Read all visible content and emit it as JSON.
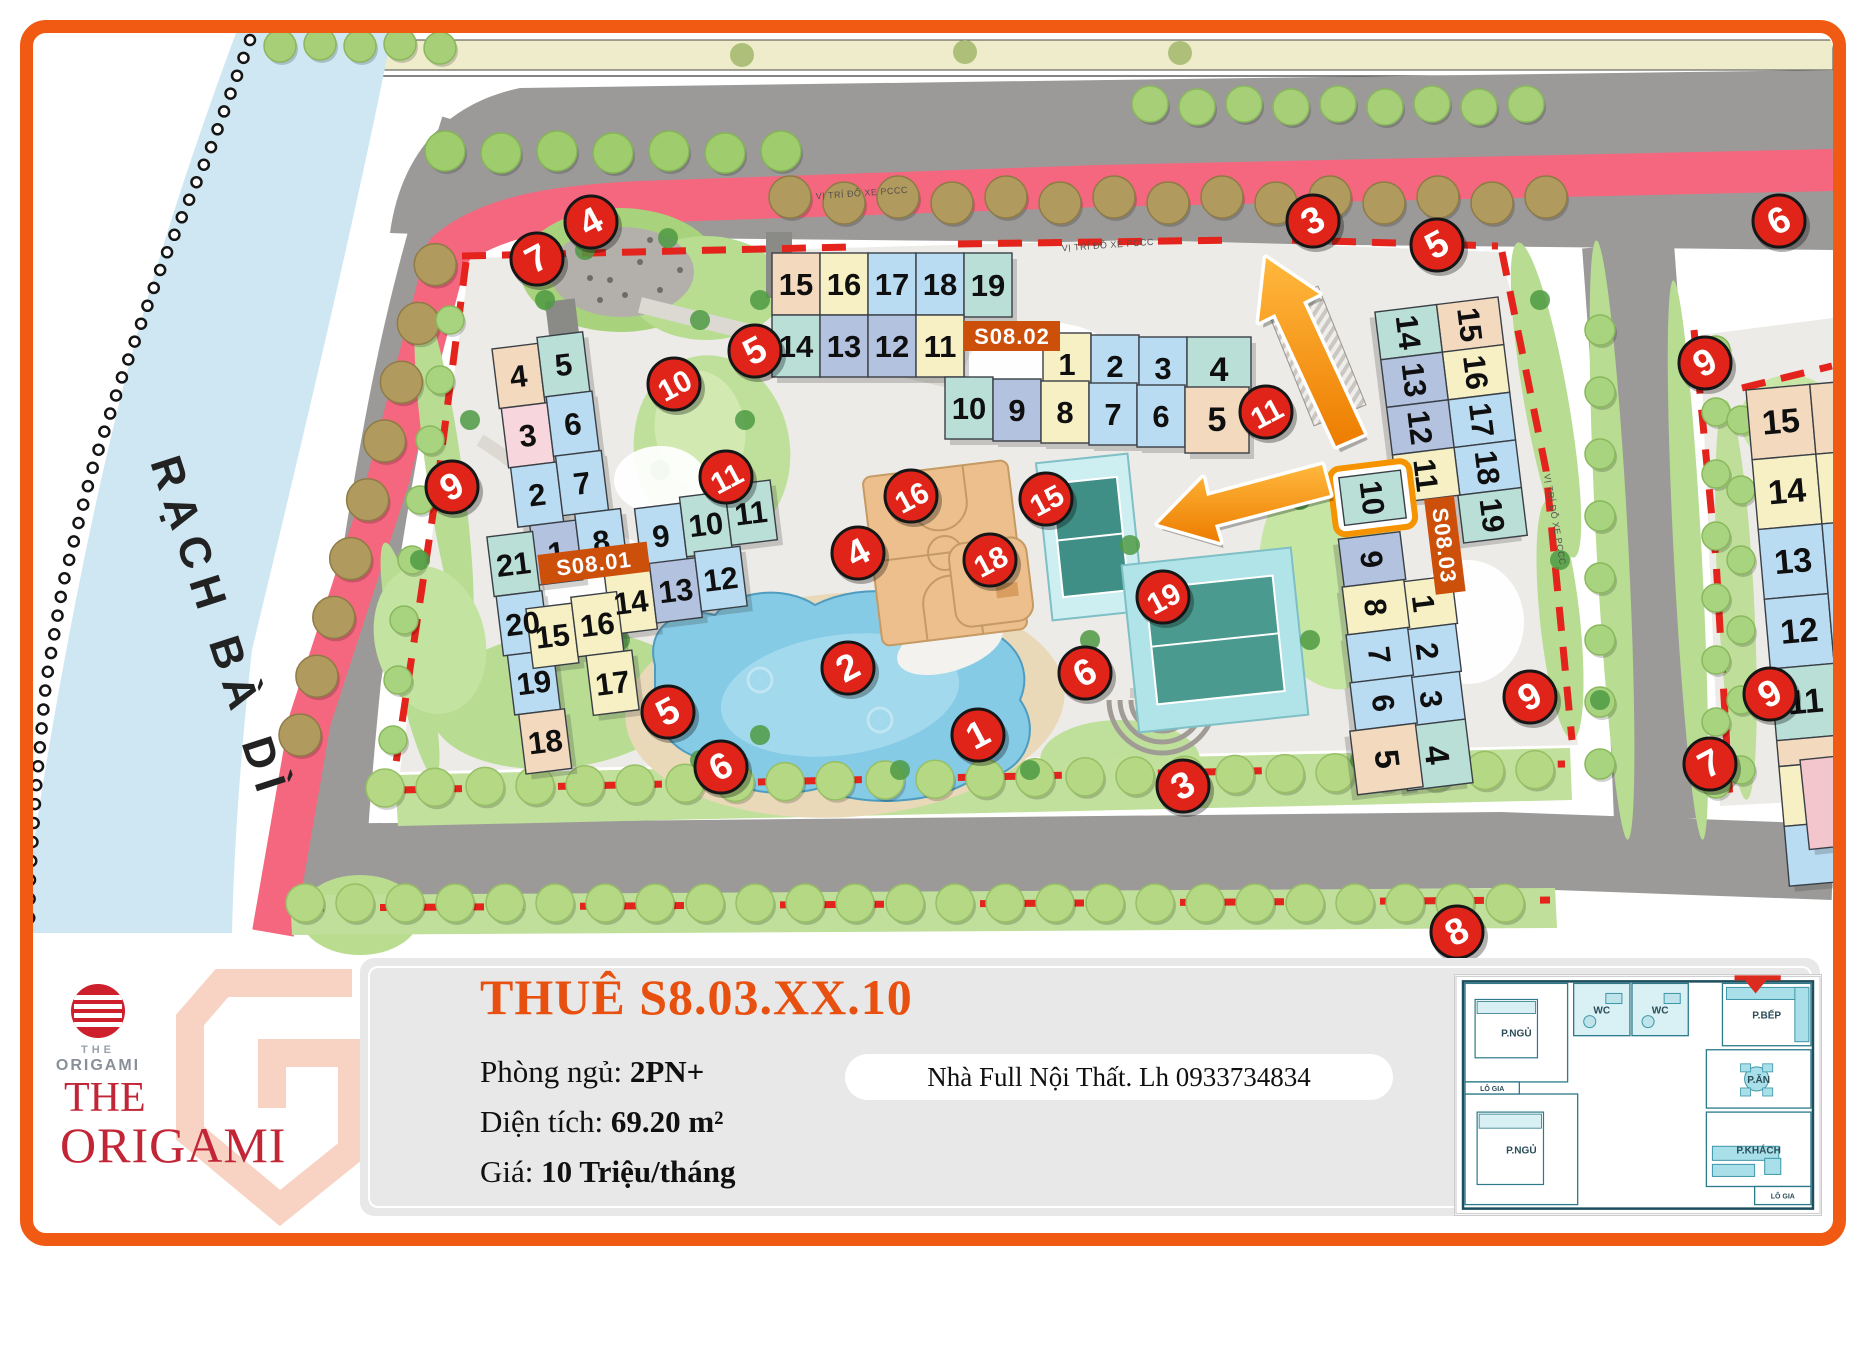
{
  "map": {
    "river_label": "RẠCH BÀ DÌ",
    "poi_note": "VỊ TRÍ ĐỖ XE PCCC",
    "accent_colors": {
      "frame": "#f15a13",
      "marker_red": "#e0241a",
      "highlight_orange": "#f59300",
      "road_pink": "#f4677f",
      "label_orange": "#cc4f0a"
    },
    "buildings": [
      {
        "name": "S08.01",
        "label": "S08.01",
        "origin": [
          492,
          349
        ],
        "rot": -7,
        "label_box": [
          20,
          210,
          110,
          30
        ],
        "cells": [
          [
            "4",
            0,
            0,
            "tan"
          ],
          [
            "5",
            46,
            -6,
            "teal"
          ],
          [
            "3",
            2,
            60,
            "pk"
          ],
          [
            "6",
            48,
            54,
            "lb"
          ],
          [
            "2",
            4,
            120,
            "lb"
          ],
          [
            "7",
            50,
            114,
            "lb"
          ],
          [
            "1",
            16,
            180,
            "bg"
          ],
          [
            "8",
            62,
            174,
            "lb"
          ],
          [
            "9",
            122,
            176,
            "lb"
          ],
          [
            "10",
            168,
            170,
            "teal"
          ],
          [
            "11",
            214,
            164,
            "teal"
          ],
          [
            "14",
            84,
            238,
            "yel"
          ],
          [
            "13",
            130,
            232,
            "bg"
          ],
          [
            "12",
            176,
            226,
            "lb"
          ],
          [
            "21",
            -28,
            186,
            "teal"
          ],
          [
            "20",
            -26,
            246,
            "lb"
          ],
          [
            "19",
            -22,
            306,
            "lb"
          ],
          [
            "18",
            -18,
            366,
            "tan"
          ],
          [
            "15",
            2,
            262,
            "yel"
          ],
          [
            "16",
            48,
            256,
            "yel"
          ],
          [
            "17",
            56,
            316,
            "yel"
          ]
        ]
      },
      {
        "name": "S08.02",
        "label": "S08.02",
        "origin": [
          772,
          253
        ],
        "rot": 0,
        "cellw": 48,
        "cellh": 62,
        "label_box": [
          192,
          68,
          96,
          30
        ],
        "cells": [
          [
            "15",
            0,
            0,
            "tan"
          ],
          [
            "16",
            48,
            0,
            "yel"
          ],
          [
            "17",
            96,
            0,
            "lb"
          ],
          [
            "18",
            144,
            0,
            "lb"
          ],
          [
            "19",
            192,
            0,
            "teal",
            48,
            64
          ],
          [
            "14",
            0,
            62,
            "teal"
          ],
          [
            "13",
            48,
            62,
            "bg"
          ],
          [
            "12",
            96,
            62,
            "bg"
          ],
          [
            "11",
            144,
            62,
            "yel"
          ],
          [
            "1",
            271,
            80,
            "yel"
          ],
          [
            "2",
            319,
            82,
            "lb"
          ],
          [
            "3",
            367,
            84,
            "lb"
          ],
          [
            "4",
            415,
            84,
            "teal",
            64,
            66
          ],
          [
            "10",
            173,
            124,
            "teal"
          ],
          [
            "9",
            221,
            126,
            "bg"
          ],
          [
            "8",
            269,
            128,
            "yel"
          ],
          [
            "7",
            317,
            130,
            "lb"
          ],
          [
            "6",
            365,
            132,
            "lb"
          ],
          [
            "5",
            413,
            134,
            "tan",
            64,
            66
          ]
        ]
      },
      {
        "name": "S08.03",
        "label": "S08.03",
        "origin": [
          1498,
          297
        ],
        "rot": 83,
        "cellw": 48,
        "cellh": 62,
        "label_box": [
          192,
          68,
          96,
          30
        ],
        "highlight": "10",
        "cells": [
          [
            "15",
            0,
            0,
            "tan"
          ],
          [
            "16",
            48,
            0,
            "yel"
          ],
          [
            "17",
            96,
            0,
            "lb"
          ],
          [
            "18",
            144,
            0,
            "lb"
          ],
          [
            "19",
            192,
            0,
            "teal",
            48,
            64
          ],
          [
            "14",
            0,
            62,
            "teal"
          ],
          [
            "13",
            48,
            62,
            "bg"
          ],
          [
            "12",
            96,
            62,
            "bg"
          ],
          [
            "11",
            144,
            62,
            "yel"
          ],
          [
            "1",
            271,
            80,
            "yel"
          ],
          [
            "2",
            319,
            82,
            "lb"
          ],
          [
            "3",
            367,
            84,
            "lb"
          ],
          [
            "4",
            415,
            84,
            "teal",
            64,
            66
          ],
          [
            "10",
            160,
            118,
            "teal"
          ],
          [
            "9",
            221,
            126,
            "bg"
          ],
          [
            "8",
            269,
            128,
            "yel"
          ],
          [
            "7",
            317,
            130,
            "lb"
          ],
          [
            "6",
            365,
            132,
            "lb"
          ],
          [
            "5",
            413,
            134,
            "tan",
            64,
            66
          ]
        ]
      },
      {
        "name": "S08-right-partial",
        "label": "",
        "origin": [
          1746,
          390
        ],
        "rot": -5,
        "cellw": 64,
        "cellh": 70,
        "cells": [
          [
            "15",
            0,
            0,
            "tan"
          ],
          [
            "14",
            0,
            70,
            "yel"
          ],
          [
            "13",
            0,
            140,
            "lb"
          ],
          [
            "12",
            0,
            210,
            "lb"
          ],
          [
            "11",
            0,
            280,
            "teal",
            64,
            72
          ],
          [
            "",
            64,
            0,
            "tan",
            26,
            70
          ],
          [
            "",
            64,
            70,
            "yel",
            26,
            70
          ],
          [
            "",
            64,
            140,
            "lb",
            26,
            140
          ],
          [
            "",
            64,
            280,
            "teal",
            26,
            72
          ],
          [
            "",
            0,
            352,
            "tan",
            64,
            26
          ],
          [
            "",
            0,
            378,
            "yel",
            60,
            60
          ],
          [
            "",
            0,
            438,
            "lb",
            60,
            60
          ]
        ]
      },
      {
        "name": "corner-partial",
        "label": "",
        "origin": [
          1800,
          760
        ],
        "rot": -6,
        "cellw": 56,
        "cellh": 90,
        "cells": [
          [
            "",
            0,
            0,
            "pink"
          ]
        ]
      }
    ],
    "markers": [
      [
        "4",
        591,
        222
      ],
      [
        "7",
        537,
        259
      ],
      [
        "3",
        1313,
        221
      ],
      [
        "5",
        1437,
        245
      ],
      [
        "6",
        1779,
        221
      ],
      [
        "9",
        452,
        487
      ],
      [
        "5",
        755,
        351
      ],
      [
        "10",
        674,
        384
      ],
      [
        "11",
        726,
        477
      ],
      [
        "16",
        911,
        496
      ],
      [
        "15",
        1046,
        499
      ],
      [
        "11",
        1266,
        412
      ],
      [
        "4",
        858,
        553
      ],
      [
        "18",
        990,
        560
      ],
      [
        "19",
        1163,
        597
      ],
      [
        "2",
        848,
        668
      ],
      [
        "6",
        1085,
        673
      ],
      [
        "5",
        668,
        712
      ],
      [
        "6",
        721,
        767
      ],
      [
        "1",
        978,
        735
      ],
      [
        "3",
        1183,
        786
      ],
      [
        "9",
        1530,
        697
      ],
      [
        "9",
        1705,
        363
      ],
      [
        "9",
        1770,
        694
      ],
      [
        "7",
        1710,
        764
      ],
      [
        "8",
        1457,
        932
      ]
    ],
    "arrows": [
      {
        "name": "arrow-to-entrance",
        "tail": [
          1350,
          440
        ],
        "tip": [
          1266,
          258
        ]
      },
      {
        "name": "arrow-from-unit-10",
        "tail": [
          1326,
          480
        ],
        "tip": [
          1158,
          524
        ]
      }
    ]
  },
  "panel": {
    "title": "THUÊ S8.03.XX.10",
    "rooms_label": "Phòng ngủ: ",
    "rooms_value": "2PN+",
    "area_label": "Diện tích: ",
    "area_value": "69.20 m²",
    "price_label": "Giá: ",
    "price_value": "10 Triệu/tháng",
    "note": "Nhà Full Nội Thất. Lh 0933734834"
  },
  "logo": {
    "small_the": "THE",
    "small_origami": "ORIGAMI",
    "the": "THE",
    "origami": "ORIGAMI"
  },
  "floorplan": {
    "rooms": [
      "P.NGỦ",
      "P.NGỦ",
      "WC",
      "WC",
      "P.BẾP",
      "P.ĂN",
      "P.KHÁCH",
      "LÔ GIA",
      "LÔ GIA"
    ]
  }
}
